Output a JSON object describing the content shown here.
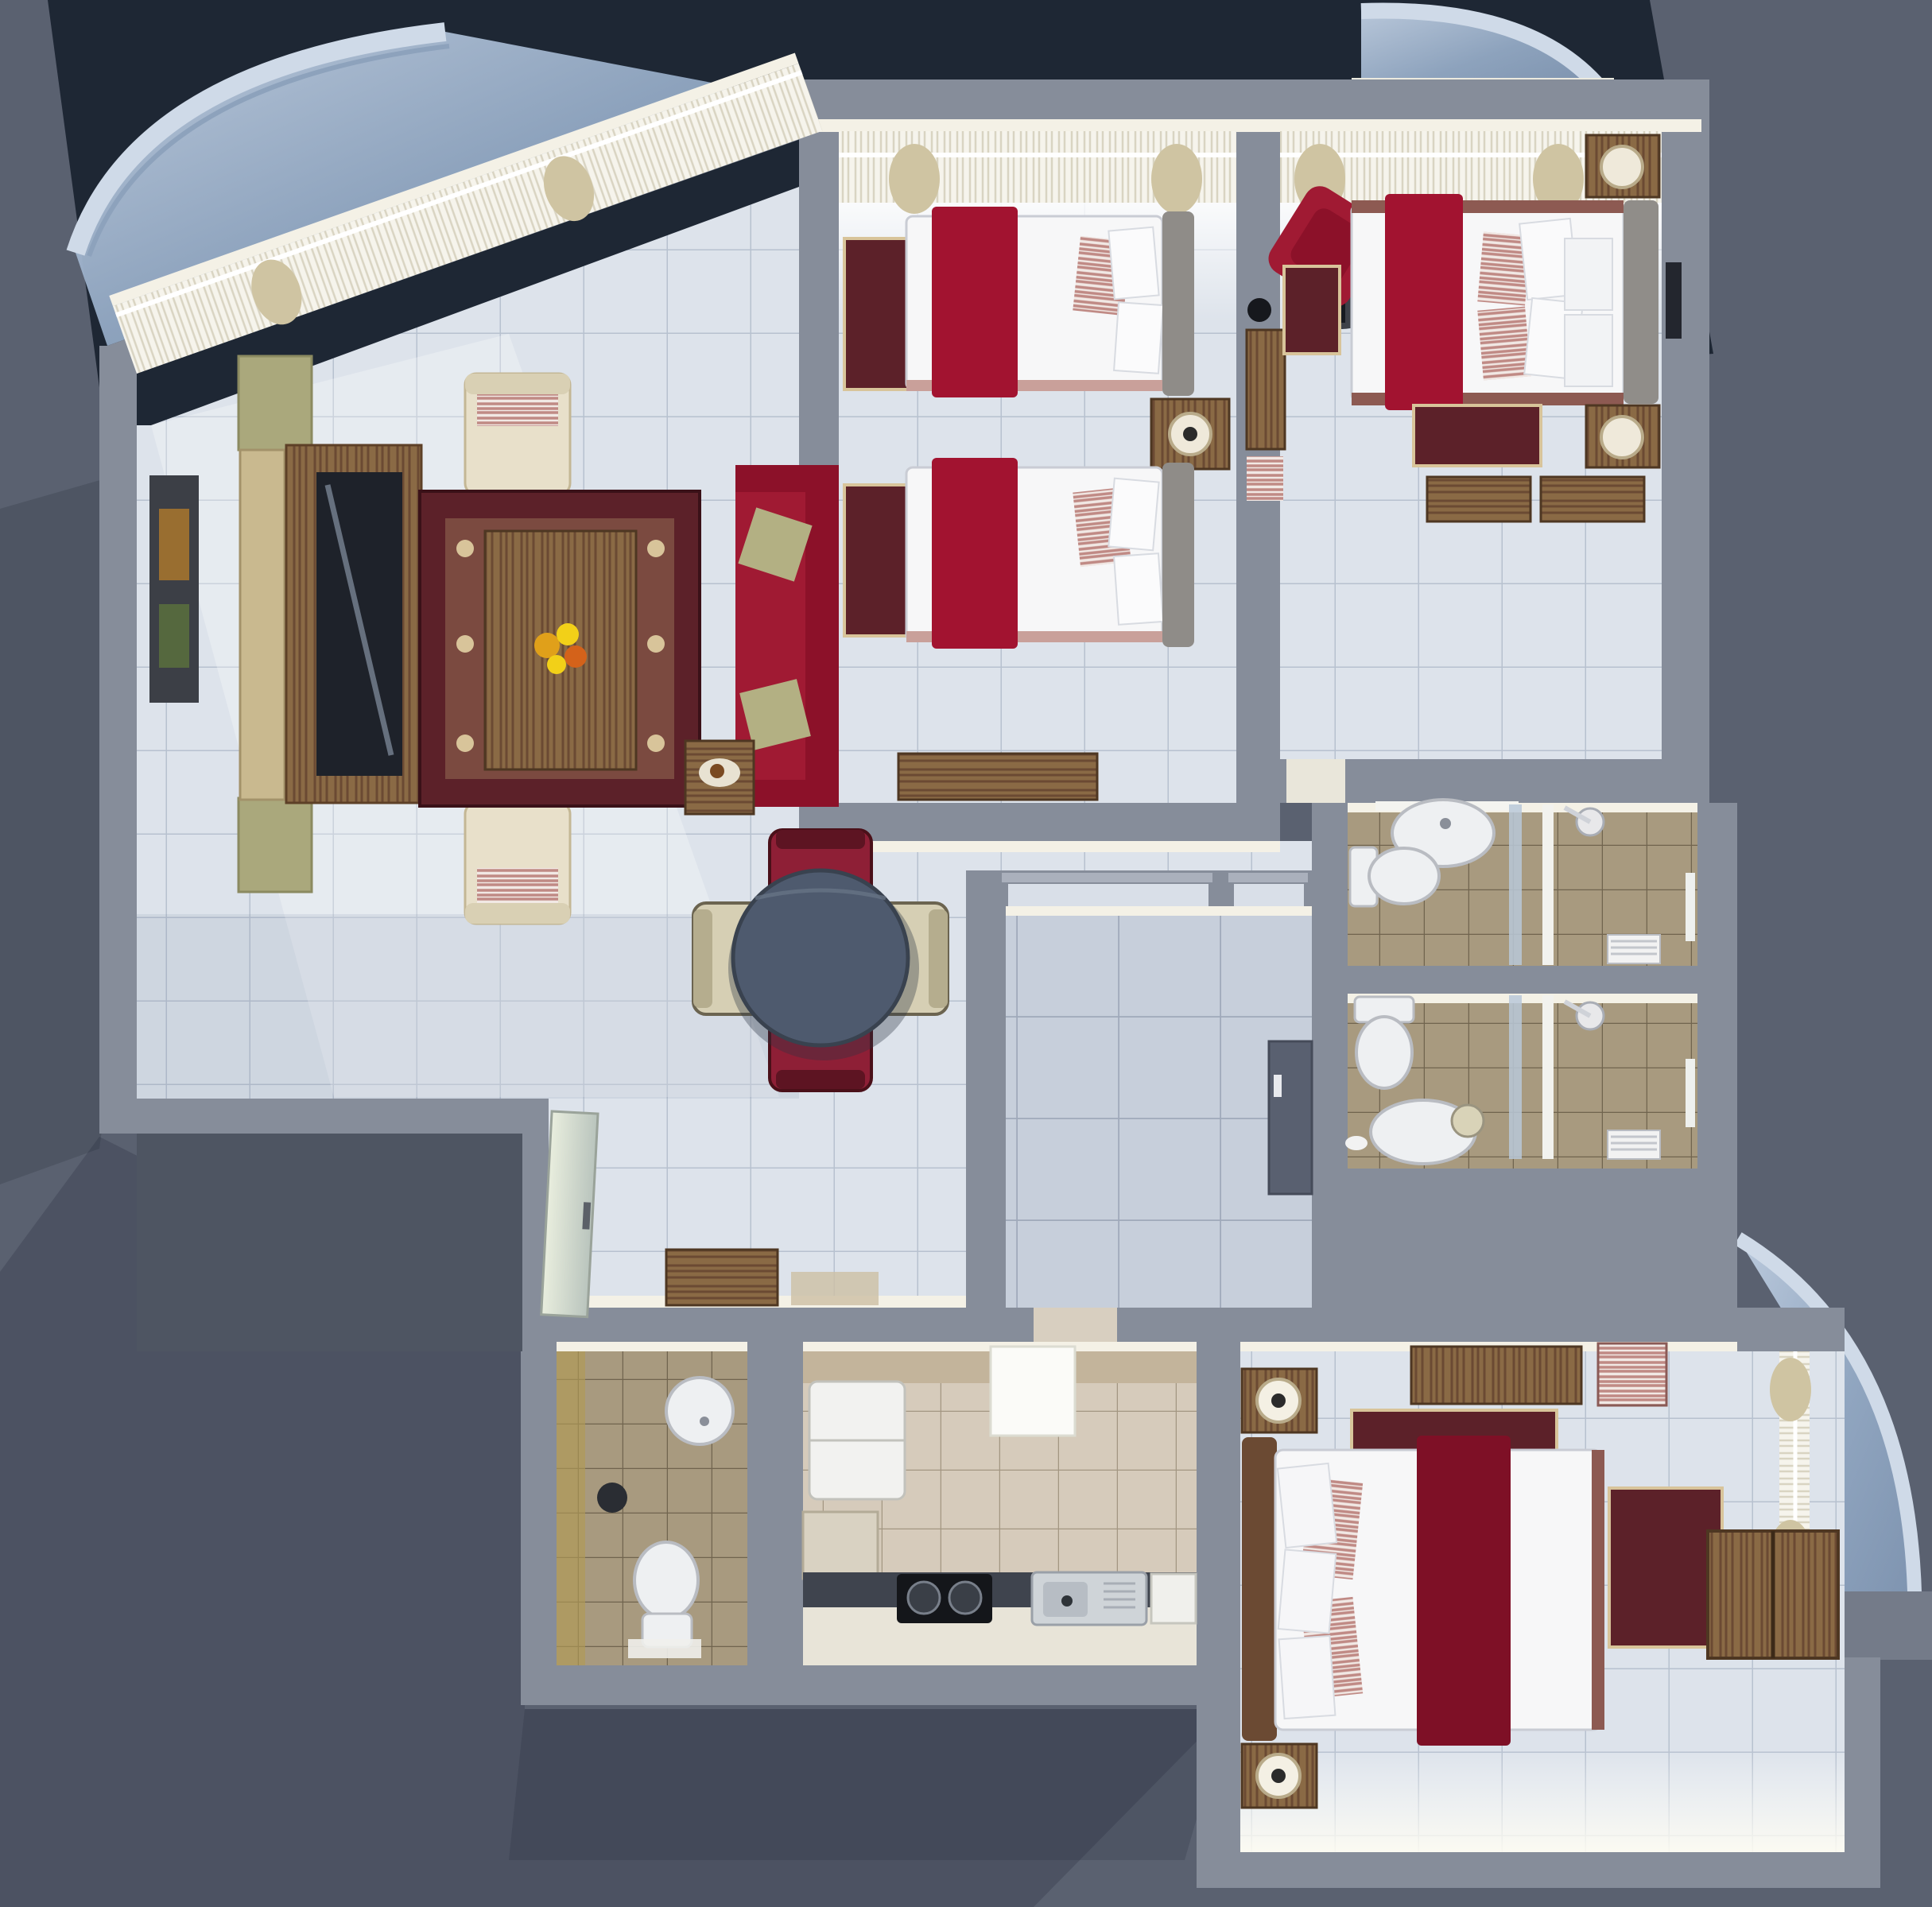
{
  "scene": {
    "title": "3D rendered apartment floor plan, top-down view",
    "style": "cutaway architectural render, no visible text"
  },
  "palette": {
    "bg": "#5a6170",
    "bgNavy": "#1e2734",
    "bgShadow": "#3f4654",
    "wall": "#868d9a",
    "wallDark": "#6e7481",
    "wallLit": "#f4f1e6",
    "floorCool": "#dde3eb",
    "floorLine": "#b7c1cf",
    "floorFoyer": "#c7cfdb",
    "floorTan": "#a89a7f",
    "floorTanLine": "#70644e",
    "floorKitchen": "#d6cbbb",
    "glass": "#9db1c9",
    "glassEdge": "#cfdae8",
    "curtain": "#cfc4a2",
    "sheer": "#f6f4ec",
    "bedWhite": "#f7f7f8",
    "red": "#a21330",
    "redDark": "#7e1026",
    "sofaRed": "#a01a33",
    "cream": "#e8e0ca",
    "wood": "#8a6a45",
    "woodDark": "#6b4a33",
    "rugBorder": "#5c2129",
    "rugField": "#7b4a40",
    "rugDot": "#d8c49a",
    "tableDark": "#4e5a6e",
    "fixtureWhite": "#eef0f2",
    "counterDark": "#3f444e",
    "applianceBlack": "#14161a"
  },
  "rooms": [
    {
      "id": "living-room",
      "label": "Living room",
      "furniture": [
        "tv-console",
        "tv",
        "screen-divider",
        "wall-art",
        "armchair",
        "armchair",
        "coffee-table",
        "area-rug",
        "flower-centerpiece",
        "red-sofa",
        "side-table"
      ]
    },
    {
      "id": "dining-area",
      "label": "Dining area",
      "furniture": [
        "round-dining-table",
        "dining-chair-red",
        "dining-chair-red",
        "dining-chair-beige",
        "dining-chair-beige",
        "shoe-bench",
        "entry-glass-door"
      ]
    },
    {
      "id": "twin-bedroom",
      "label": "Twin bedroom",
      "furniture": [
        "single-bed",
        "single-bed",
        "nightstand-with-lamp",
        "bedside-rug",
        "bedside-rug",
        "desk",
        "wall-desk",
        "stool"
      ]
    },
    {
      "id": "master-bedroom",
      "label": "Master bedroom",
      "furniture": [
        "double-bed",
        "office-chair-red",
        "nightstand-with-lamp",
        "nightstand-with-lamp",
        "bedside-rug",
        "bedside-rug",
        "bench",
        "bench",
        "wall-art"
      ]
    },
    {
      "id": "bathroom-ensuite",
      "label": "Bathroom 1",
      "furniture": [
        "washbasin",
        "toilet",
        "shower",
        "glass-partition",
        "towel-radiator"
      ]
    },
    {
      "id": "bathroom-second",
      "label": "Bathroom 2",
      "furniture": [
        "toilet",
        "washbasin",
        "mirror",
        "shower",
        "glass-partition",
        "towel-radiator"
      ]
    },
    {
      "id": "foyer",
      "label": "Entrance foyer",
      "furniture": [
        "wardrobe-cabinet",
        "door-lintel",
        "door-lintel"
      ]
    },
    {
      "id": "guest-wc",
      "label": "Guest WC",
      "furniture": [
        "round-washbasin",
        "toilet",
        "waste-bin",
        "bath-mat"
      ]
    },
    {
      "id": "kitchen",
      "label": "Kitchen",
      "furniture": [
        "refrigerator",
        "ceiling-lamp",
        "counter",
        "cooktop",
        "kitchen-sink",
        "dish-rack"
      ]
    },
    {
      "id": "third-bedroom",
      "label": "Bedroom 3",
      "furniture": [
        "double-bed",
        "nightstand-with-lamp",
        "nightstand-with-lamp",
        "dresser",
        "striped-chair",
        "area-rug",
        "area-rug",
        "wardrobe",
        "window-curtains"
      ]
    }
  ],
  "balconies": [
    {
      "id": "balcony-top-left",
      "label": "Curved glass balcony (top left)"
    },
    {
      "id": "balcony-top-right",
      "label": "Curved glass balcony (top right)"
    },
    {
      "id": "balcony-bottom-right",
      "label": "Curved glass balcony (bottom right)"
    }
  ]
}
